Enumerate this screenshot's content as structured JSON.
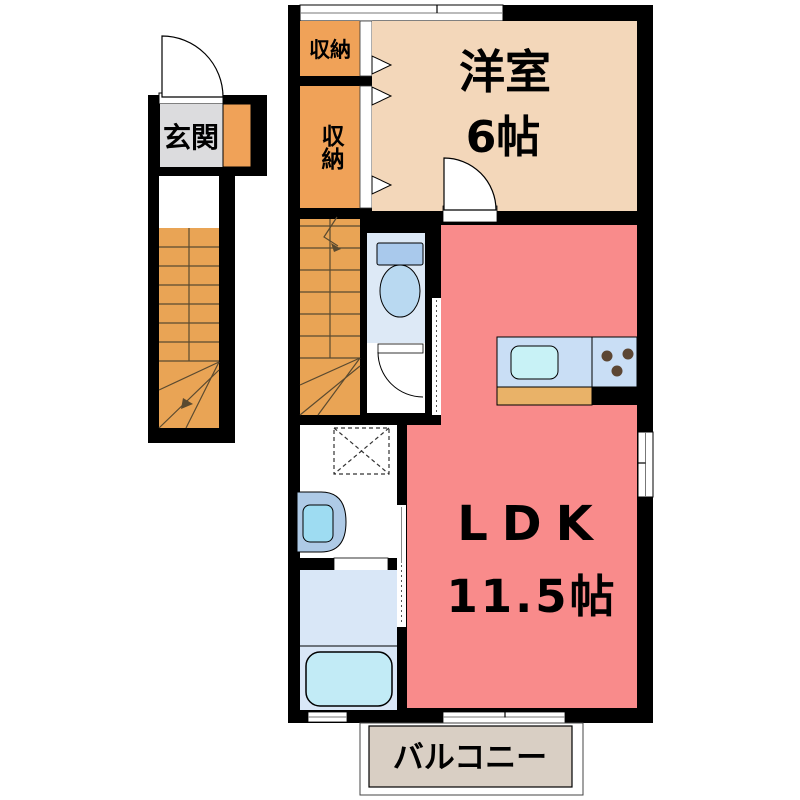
{
  "colors": {
    "wall": "#000000",
    "background": "#ffffff",
    "closet": "#f0a258",
    "stairs": "#e9a455",
    "western_room": "#f3d7ba",
    "ldk": "#f98b8b",
    "entrance_floor": "#dcdcde",
    "shoe_cabinet": "#f0a258",
    "toilet_room": "#dde9f6",
    "toilet_tank": "#a9c9ec",
    "toilet_bowl": "#b9d9f1",
    "bathroom": "#d9e7f7",
    "bathtub": "#c2ebf6",
    "counter": "#c9def5",
    "sink": "#c8f2f6",
    "counter_front": "#e9b268",
    "burner": "#5c4633",
    "basin_outer": "#aecae6",
    "basin_inner": "#9edcf2",
    "balcony": "#d9cfc4"
  },
  "labels": {
    "entrance": "玄関",
    "closet_top": "収納",
    "closet_side": "収納",
    "western_room": "洋室",
    "western_room_size": "6帖",
    "ldk": "LDK",
    "ldk_size": "11.5帖",
    "balcony": "バルコニー"
  }
}
